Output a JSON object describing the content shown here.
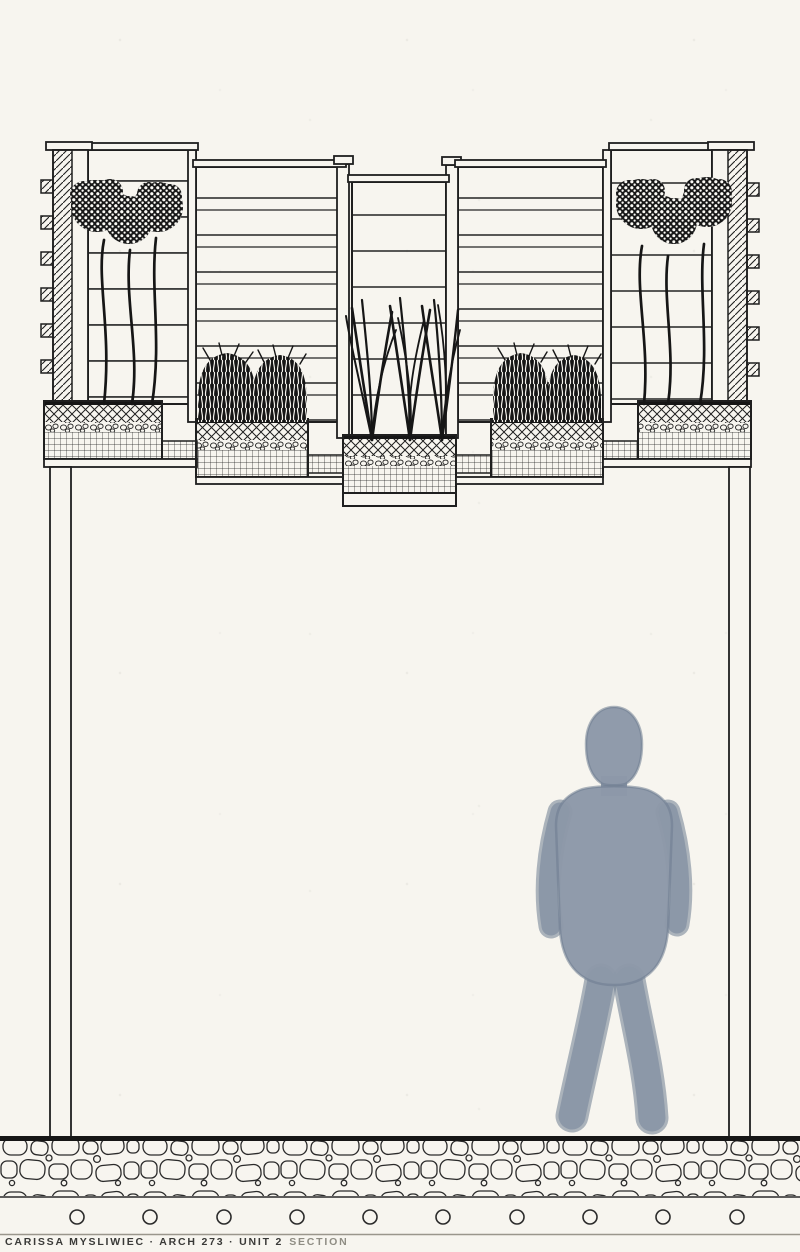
{
  "caption": {
    "text_main": "CARISSA MYSLIWIEC · ARCH 273 · UNIT 2",
    "text_faint": "SECTION",
    "full_text": "CARISSA MYSLIWIEC · ARCH 273 · UNIT 2 SECTION",
    "author": "CARISSA MYSLIWIEC",
    "course": "ARCH 273",
    "sheet": "UNIT 2 SECTION"
  },
  "colors": {
    "paper": "#f7f5ef",
    "ink": "#1f1f1f",
    "pencil": "#9a968c",
    "figure_fill": "#8c98a8",
    "figure_edge": "#6e7c90"
  },
  "drawing": {
    "kind": "hand-drawn architectural section",
    "parts": [
      "slatted trellis screens",
      "hatched anchor posts with wall tabs",
      "stepped planter boxes with soil, gravel and drainage layers",
      "allium flowers",
      "ornamental grasses",
      "shrub mounds",
      "interior wall columns",
      "human figure silhouette",
      "stone ground slab",
      "anchor circles"
    ],
    "counts": {
      "trellis_screens": 5,
      "planter_boxes": 5,
      "anchor_circles": 10,
      "bracket_tabs_per_post": 6,
      "allium_stems_per_side": 3,
      "grass_clumps": 3,
      "shrub_mounds": 4
    }
  }
}
